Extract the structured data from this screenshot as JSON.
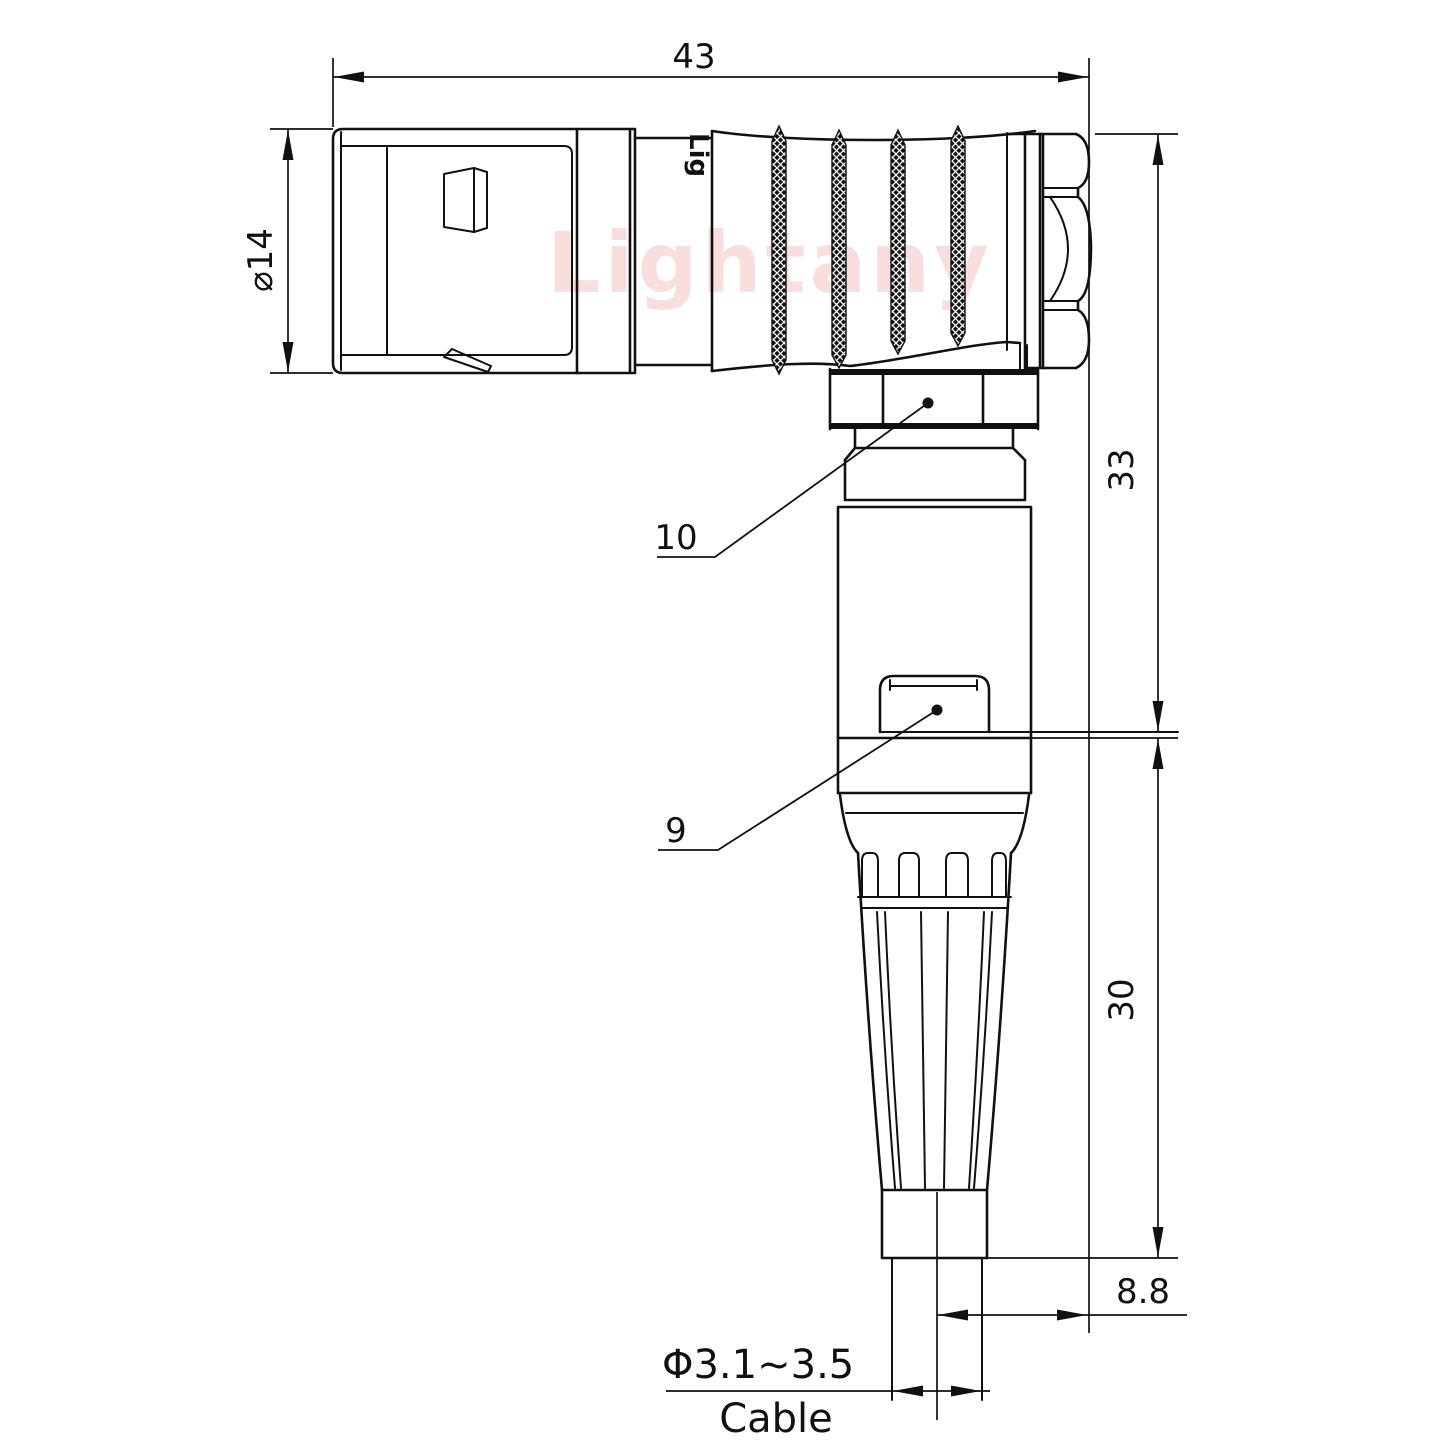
{
  "title": "Right-angle connector technical drawing",
  "watermark": {
    "text": "Lightany"
  },
  "brand_mark": {
    "text": "Lig"
  },
  "colors": {
    "line": "#111111",
    "watermark": "#f2bfbd"
  },
  "dimensions": {
    "overall_length": "43",
    "body_diameter": "⌀14",
    "height_upper": "33",
    "height_lower": "30",
    "axis_offset": "8.8",
    "cable_range": "Φ3.1~3.5",
    "cable_label": "Cable"
  },
  "part_labels": {
    "coupling_nut": "10",
    "clip": "9"
  }
}
